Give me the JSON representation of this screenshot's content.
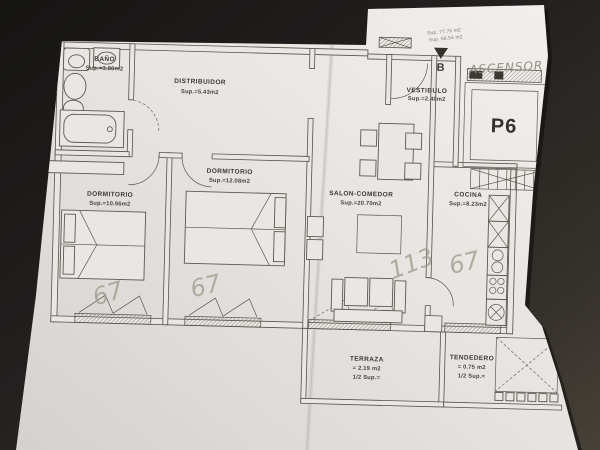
{
  "colors": {
    "background_dark": "#1c1a18",
    "paper": "#e8e6e2",
    "ink": "#56514b",
    "pencil": "#a49c8f"
  },
  "rooms": {
    "bano": {
      "name": "BAÑO",
      "sup": "Sup.=3.80m2"
    },
    "distribuidor": {
      "name": "DISTRIBUIDOR",
      "sup": "Sup.=5.43m2"
    },
    "vestibulo": {
      "name": "VESTIBULO",
      "sup": "Sup.=2.40m2"
    },
    "dormitorio1": {
      "name": "DORMITORIO",
      "sup": "Sup.=10.96m2"
    },
    "dormitorio2": {
      "name": "DORMITORIO",
      "sup": "Sup.=12.08m2"
    },
    "salon": {
      "name": "SALON-COMEDOR",
      "sup": "Sup.=20.70m2"
    },
    "cocina": {
      "name": "COCINA",
      "sup": "Sup.=8.23m2"
    },
    "terraza": {
      "name": "TERRAZA",
      "sup_line1": "= 2.19  m2",
      "sup_line2": "1/2  Sup.="
    },
    "tendedero": {
      "name": "TENDEDERO",
      "sup_line1": "=  0.75  m2",
      "sup_line2": "1/2  Sup.="
    }
  },
  "labels": {
    "elevator_unit": "P6",
    "block_letter": "B",
    "note_line1": "Sup. 77.70 m2",
    "note_line2": "Sup. 56.54 m2"
  },
  "handwriting": {
    "ascensor": "ASCENSOR",
    "mark_dormitorio1": "67",
    "mark_dormitorio2": "67",
    "mark_salon": "113",
    "mark_cocina": "67"
  }
}
